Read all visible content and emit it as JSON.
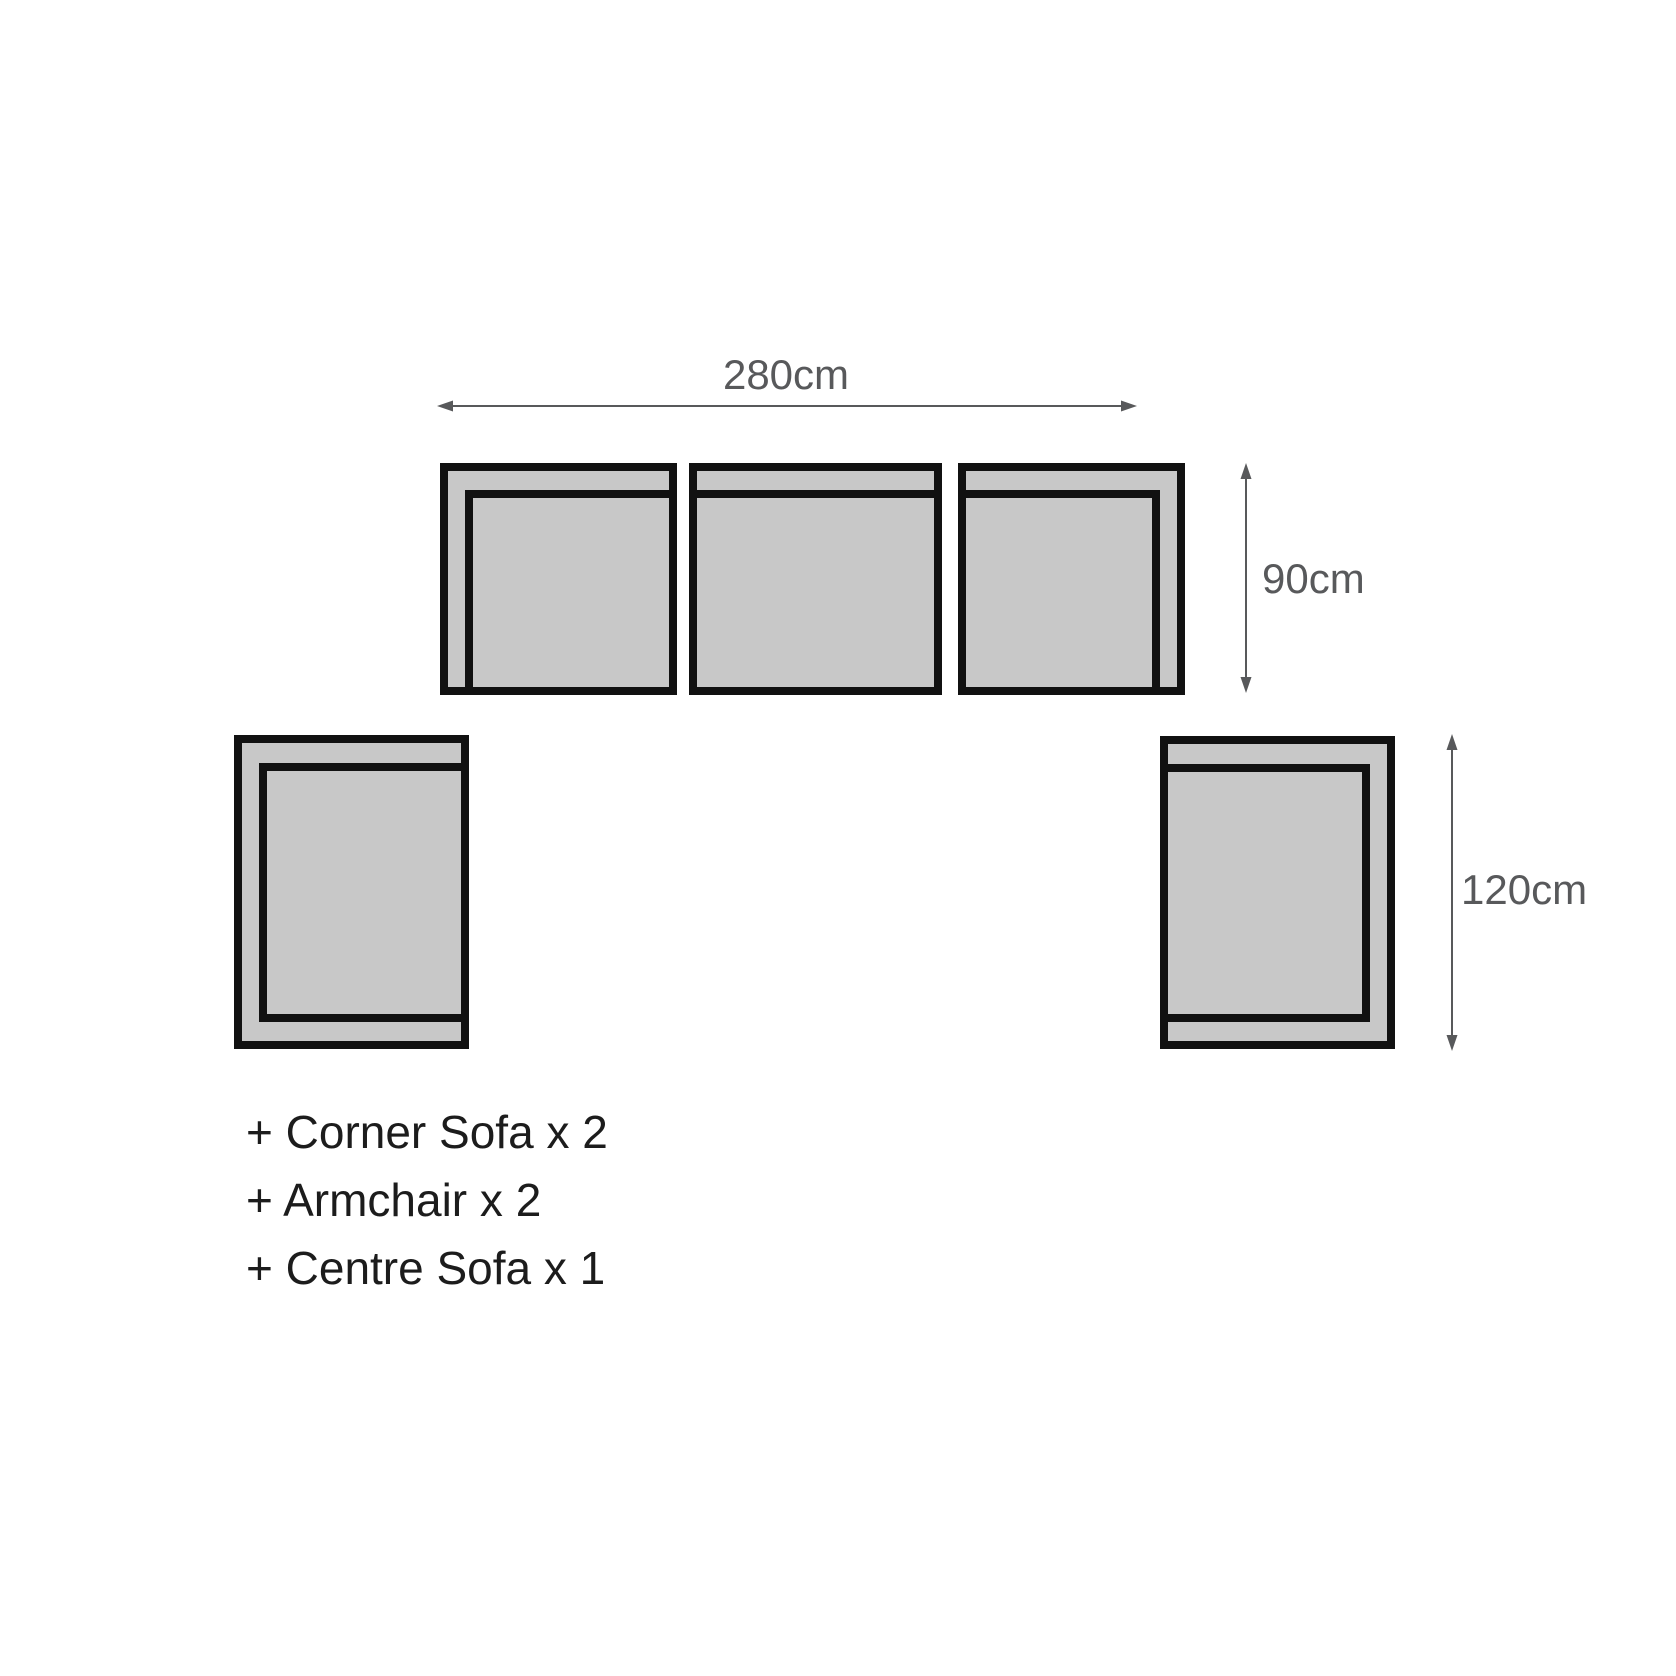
{
  "diagram": {
    "colors": {
      "piece_fill": "#c8c8c8",
      "piece_outline": "#111111",
      "dimension": "#58595b",
      "legend_text": "#1c1c1c"
    },
    "dimensions": {
      "width": {
        "label": "280cm"
      },
      "depth": {
        "label": "90cm"
      },
      "side_depth": {
        "label": "120cm"
      }
    },
    "pieces": [
      {
        "name": "corner-sofa-left"
      },
      {
        "name": "centre-sofa"
      },
      {
        "name": "corner-sofa-right"
      },
      {
        "name": "armchair-left"
      },
      {
        "name": "armchair-right"
      }
    ]
  },
  "legend": {
    "items": [
      "+ Corner Sofa x 2",
      "+ Armchair x 2",
      "+ Centre Sofa x 1"
    ]
  }
}
